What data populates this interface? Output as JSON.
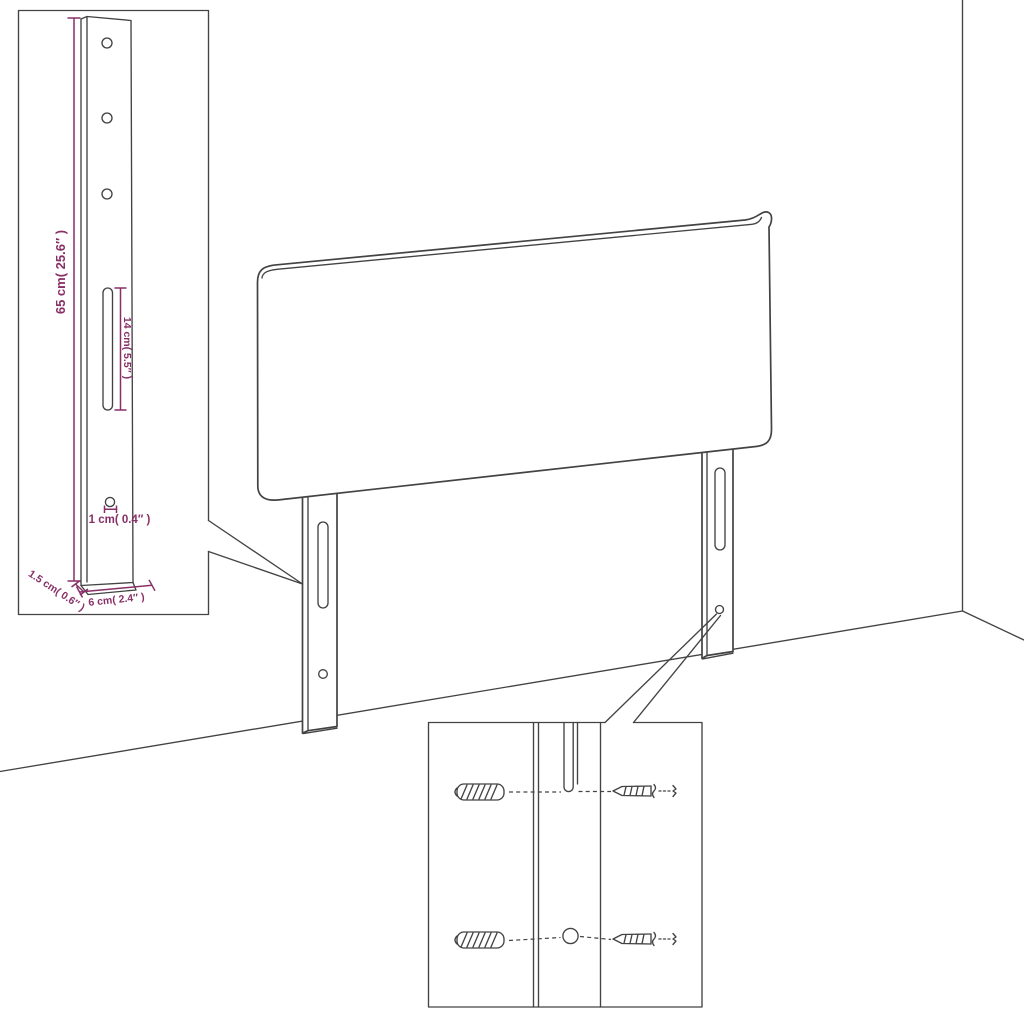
{
  "diagram": {
    "subject": "headboard-with-mounting-legs-assembly-diagram",
    "labels": {
      "leg_height": "65 cm( 25.6″ )",
      "slot_length": "14 cm( 5.5″ )",
      "hole_size": "1 cm( 0.4″ )",
      "leg_depth": "1.5 cm( 0.6″ )",
      "leg_width": "6 cm( 2.4″ )"
    },
    "colors": {
      "line": "#434343",
      "dimension": "#882f66",
      "background": "#ffffff"
    }
  }
}
